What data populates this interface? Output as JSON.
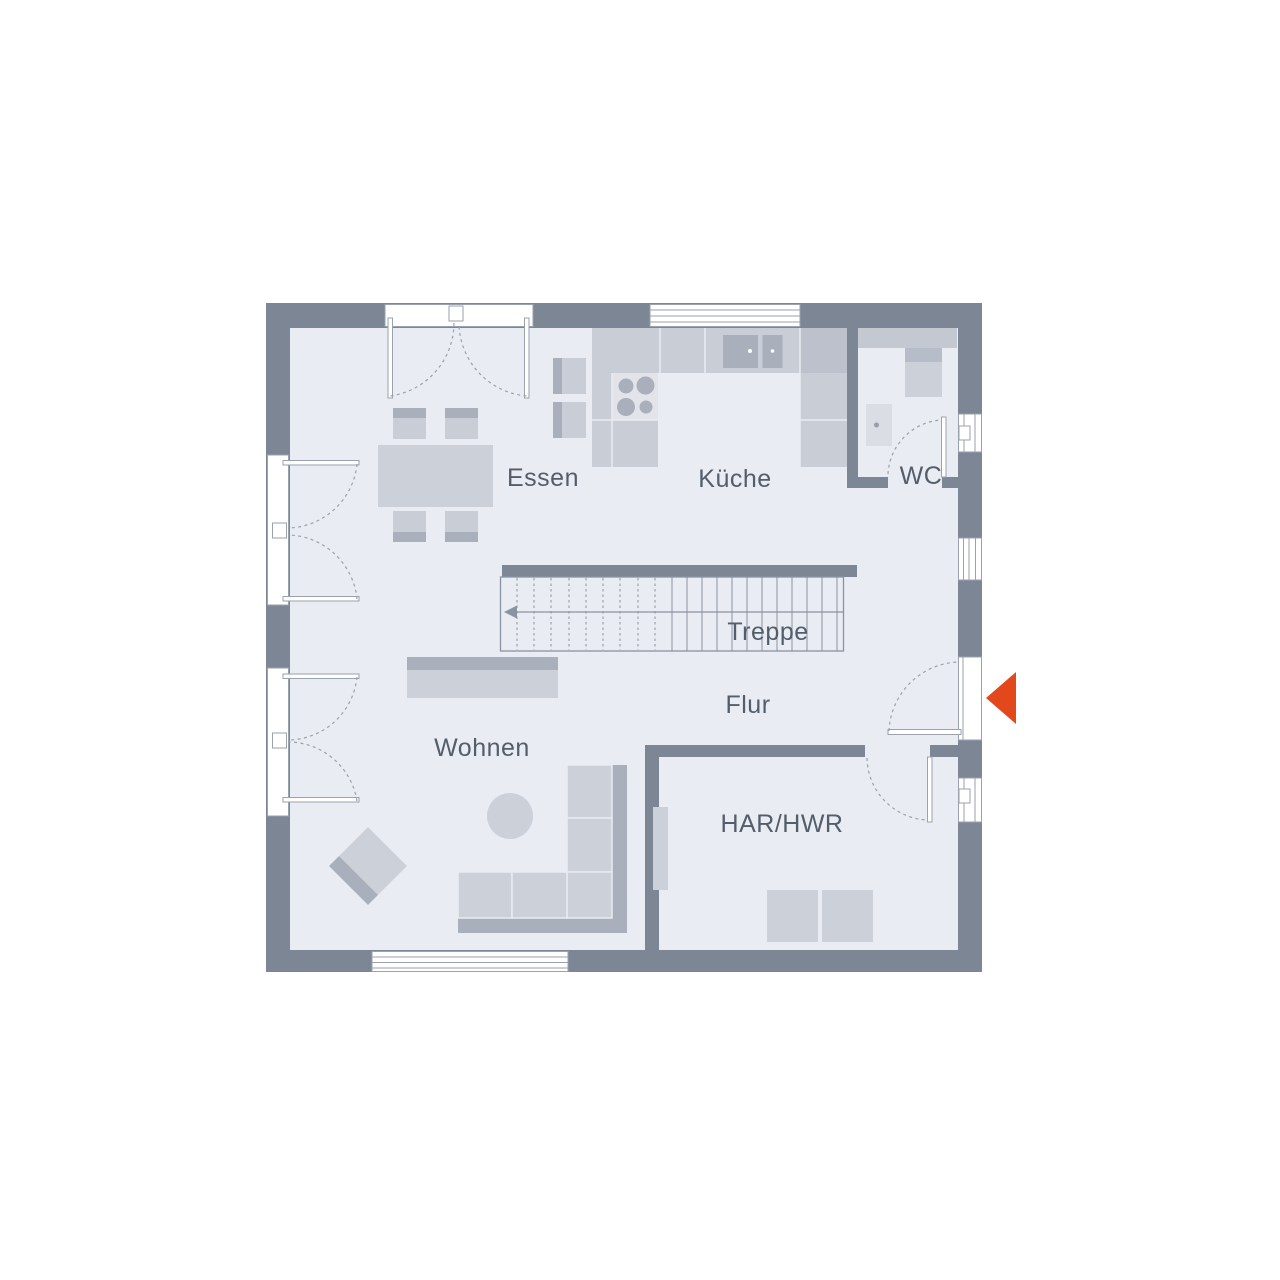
{
  "labels": {
    "essen": "Essen",
    "kueche": "Küche",
    "wc": "WC",
    "treppe": "Treppe",
    "flur": "Flur",
    "wohnen": "Wohnen",
    "har": "HAR/HWR"
  },
  "colors": {
    "floor": "#e9ecf2",
    "wall": "#7c8695",
    "line": "#9aa2ae",
    "stair_line": "#8a93a1",
    "furniture": "#ccd0d9",
    "furniture_mid": "#c9cdd6",
    "furniture_dark": "#a9afbb",
    "counter_dark": "#bcc1cb",
    "fixture": "#c3c8d1",
    "fixture_dark": "#b7bdc8",
    "fixture_light": "#dadde4",
    "appliance": "#e2e4ea",
    "text": "#545d6a",
    "arrow": "#e2481c"
  }
}
